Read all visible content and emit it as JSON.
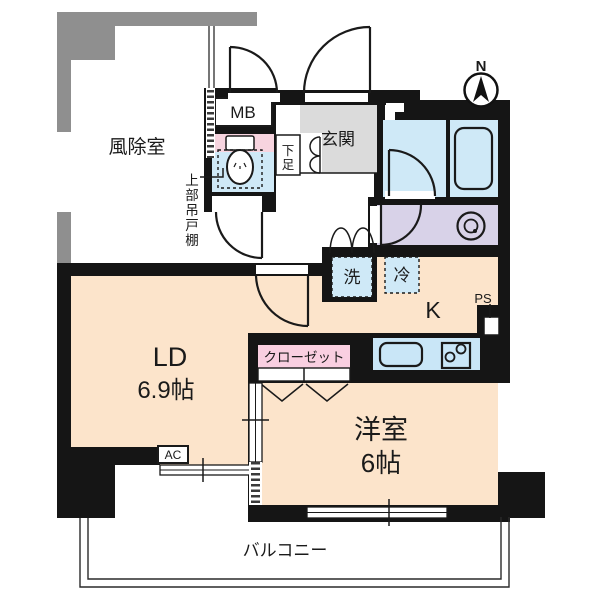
{
  "floorplan": {
    "compass_north": "N",
    "labels": {
      "windbreak": "風除室",
      "meter_box": "MB",
      "entrance": "玄関",
      "shoe_chars": [
        "下",
        "足"
      ],
      "cabinet_chars": [
        "上",
        "部",
        "吊",
        "戸",
        "棚"
      ],
      "washer": "洗",
      "fridge": "冷",
      "kitchen": "K",
      "pipe_space": "PS",
      "living_dining": "LD",
      "living_dining_size": "6.9帖",
      "closet": "クローゼット",
      "western_room": "洋室",
      "western_room_size": "6帖",
      "air_conditioner": "AC",
      "balcony": "バルコニー"
    },
    "colors": {
      "wall_black": "#151515",
      "wall_gray": "#8f8f8f",
      "floor_ldk": "#fce4cb",
      "floor_bath": "#cfe9f7",
      "floor_washroom": "#d8d2e8",
      "floor_entrance": "#dbdbdb",
      "closet_pink": "#f9cfe1",
      "toilet_pink": "#f7d4df",
      "counter_blue": "#c9e6f7",
      "appliance_blue": "#cfe9f7",
      "windbreak_label_gray": "#9a9a9a"
    }
  }
}
